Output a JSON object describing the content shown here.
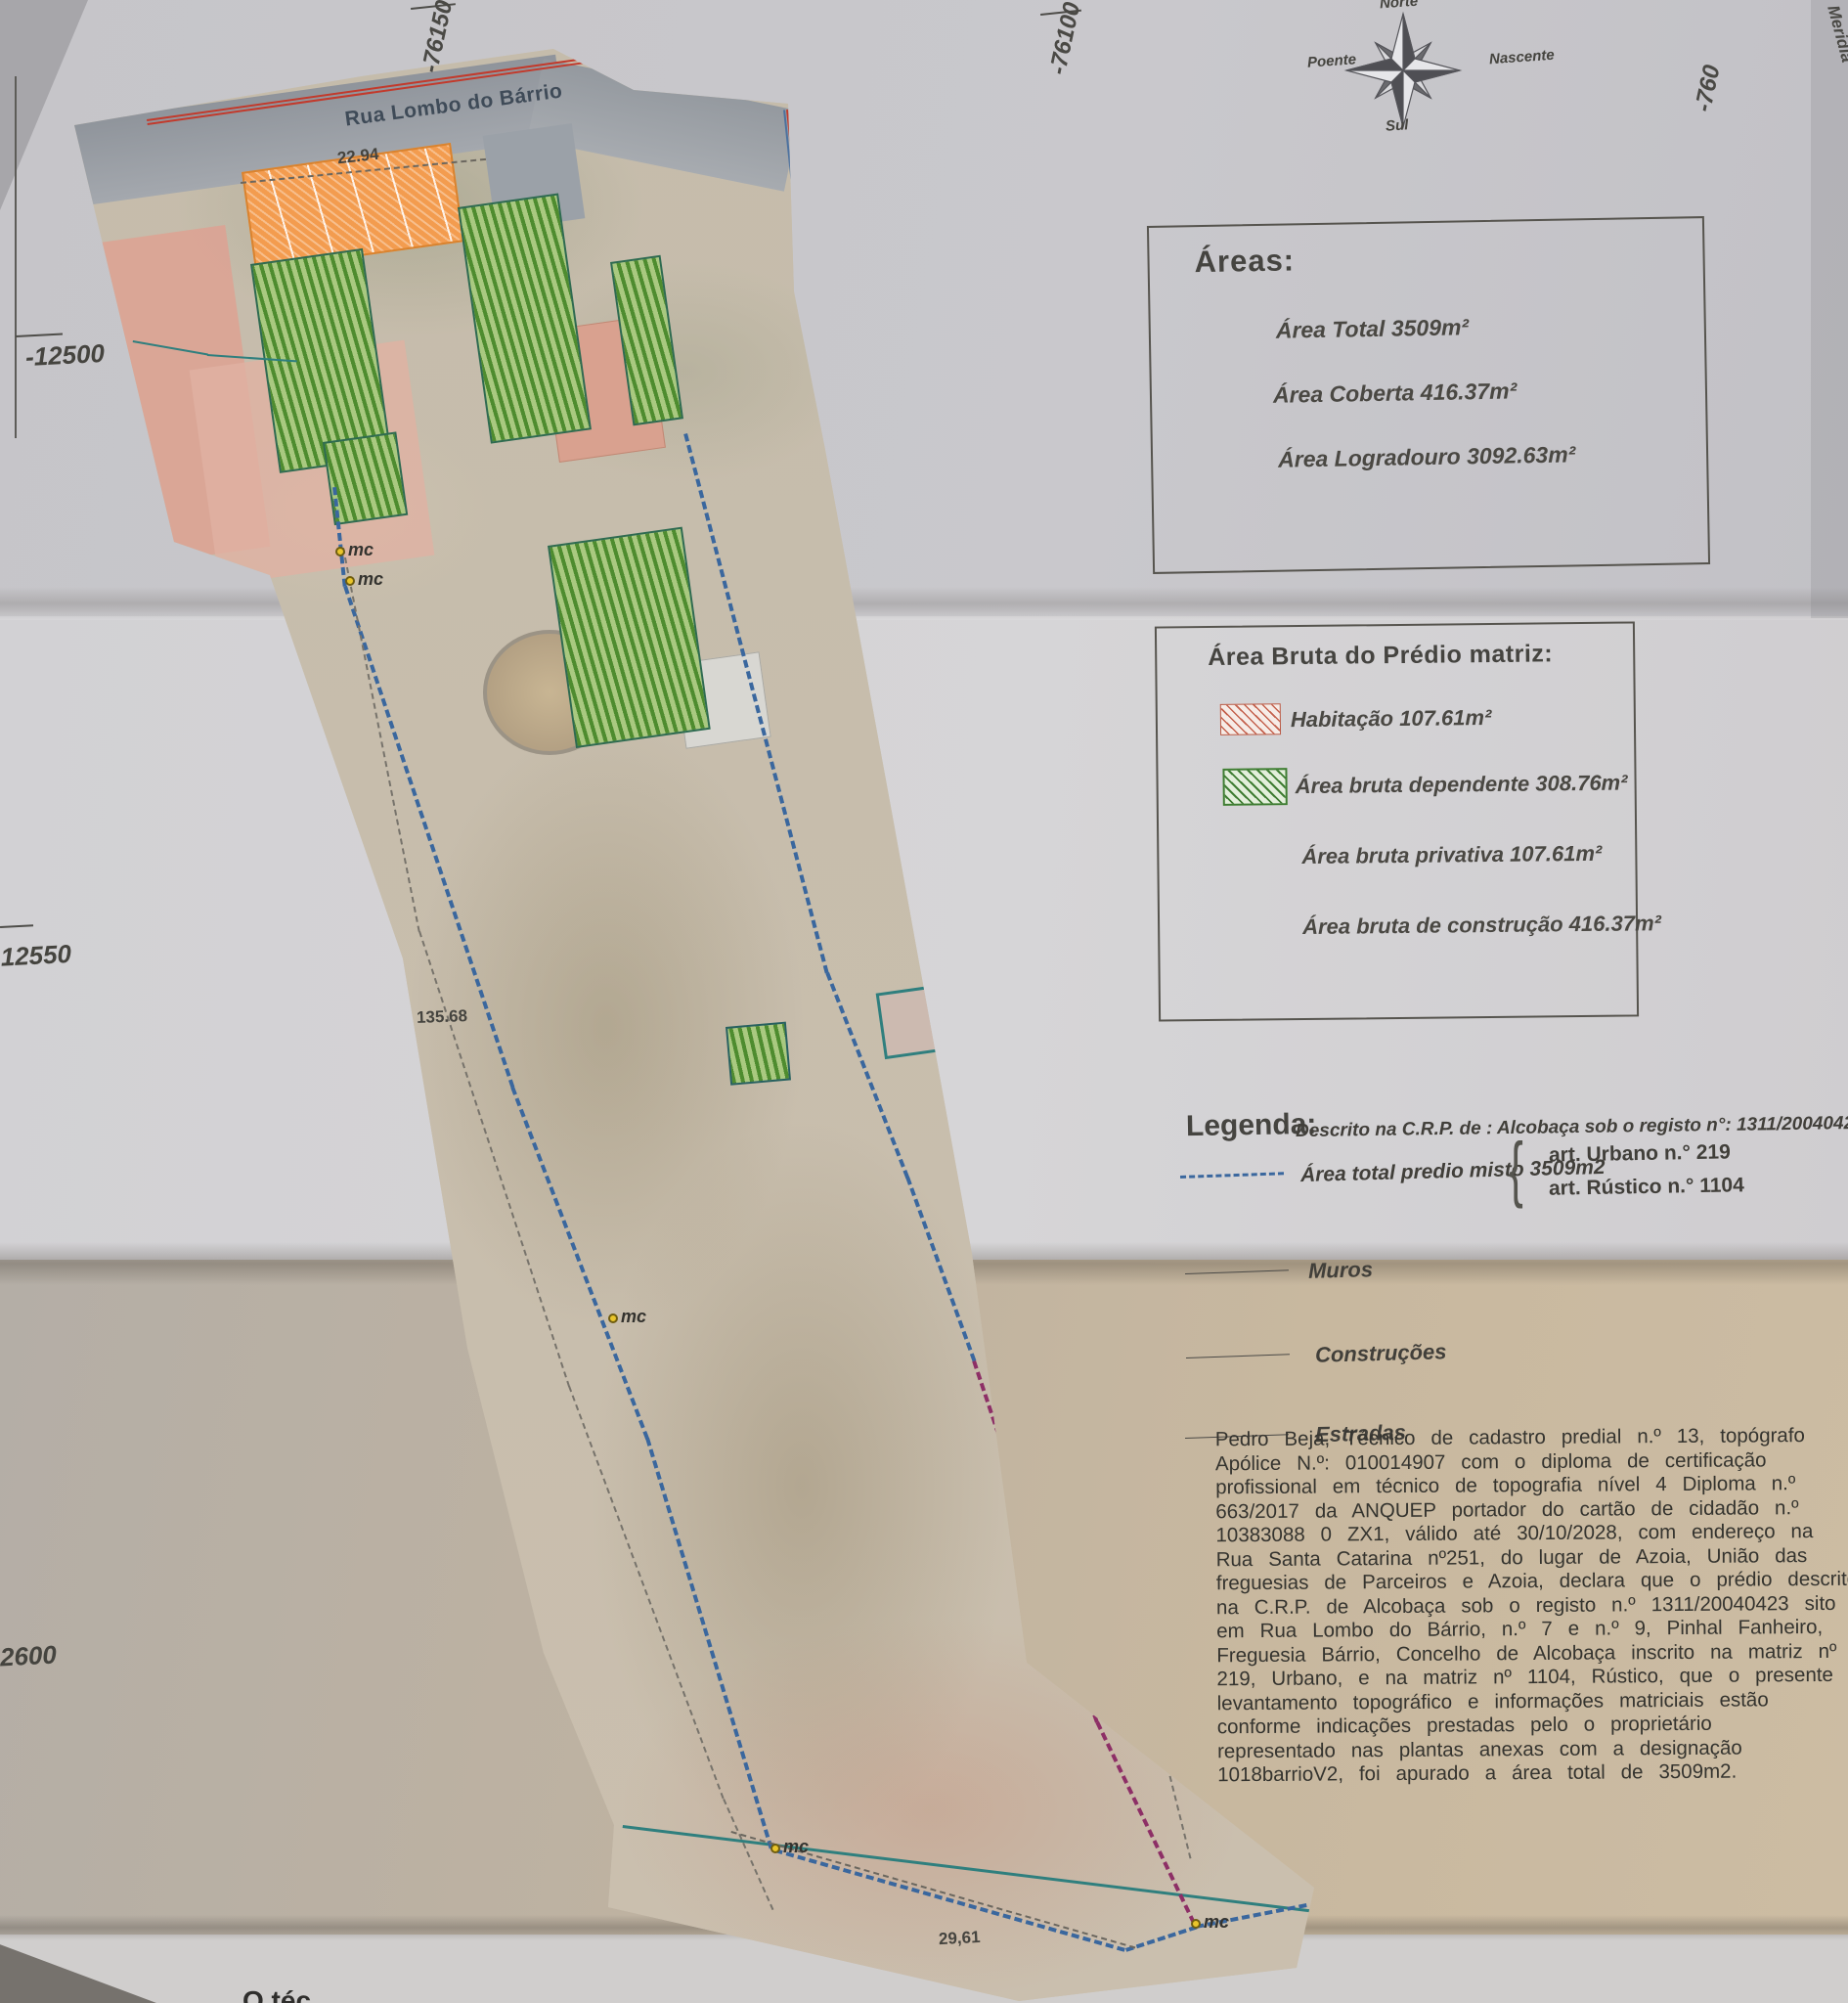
{
  "compass": {
    "north": "Norte",
    "south": "Sul",
    "east": "Nascente",
    "west": "Poente"
  },
  "grid": {
    "x_76150": "-76150",
    "x_76100": "-76100",
    "x_760": "-760",
    "edge_meridian": "Meridia",
    "y_12500": "-12500",
    "y_12550": "-12550",
    "y_2600": "2600"
  },
  "map": {
    "street": "Rua Lombo do Bárrio",
    "mc_label": "mc",
    "measurements": {
      "top": "22.94",
      "left": "135.68",
      "right": "145.37",
      "bottom": "29,61"
    }
  },
  "areas_box": {
    "title": "Áreas:",
    "items": [
      "Área Total 3509m²",
      "Área  Coberta 416.37m²",
      "Área Logradouro 3092.63m²"
    ]
  },
  "bruta_box": {
    "title": "Área Bruta do Prédio matriz:",
    "habitacao": "Habitação 107.61m²",
    "dependente": "Área bruta dependente 308.76m²",
    "privativa": "Área bruta privativa 107.61m²",
    "construcao": "Área bruta de construção 416.37m²"
  },
  "legend": {
    "title": "Legenda:",
    "registo": "Descrito na C.R.P. de : Alcobaça sob o registo n°: 1311/20040423",
    "area_total": "Área total predio misto 3509m2",
    "art_urbano": "art.  Urbano n.° 219",
    "art_rustico": "art.  Rústico n.° 1104",
    "muros": "Muros",
    "construcoes": "Construções",
    "estradas": "Estradas"
  },
  "declaration": {
    "lines": [
      "Pedro Beja, Técnico de cadastro predial n.º 13, topógrafo",
      "Apólice N.º: 010014907 com o diploma de certificação",
      "profissional em técnico de topografia nível 4 Diploma n.º",
      "663/2017 da ANQUEP portador do cartão de cidadão n.º",
      "10383088 0 ZX1, válido até 30/10/2028, com endereço na",
      "Rua Santa Catarina nº251, do lugar de Azoia, União das",
      "freguesias de Parceiros e Azoia, declara que o prédio descrito",
      "na C.R.P. de Alcobaça sob o registo n.º 1311/20040423 sito",
      "em Rua Lombo do Bárrio, n.º 7 e n.º 9, Pinhal Fanheiro,",
      "Freguesia Bárrio, Concelho de Alcobaça inscrito na matriz nº",
      "219, Urbano, e na matriz nº 1104, Rústico,  que o presente",
      "levantamento topográfico e informações matriciais estão",
      "conforme indicações prestadas pelo o proprietário",
      "representado nas plantas anexas com a designação",
      "1018barrioV2, foi apurado a área total de 3509m2."
    ]
  },
  "page": {
    "bottom_cut_text": "O téc"
  },
  "colors": {
    "boundary_blue": "#3a679e",
    "muro_teal": "#2f7f7e",
    "estrada_red": "#c23a2c",
    "boundary_purple": "#8d2f66",
    "mc_yellow": "#e9c52b",
    "habitacao_hatch": "#c4614d",
    "dependente_green": "#4e8c2f",
    "building_orange": "#f39c4f",
    "paper_gray": "#c8c7cb",
    "paper_tan": "#c4b49d"
  }
}
